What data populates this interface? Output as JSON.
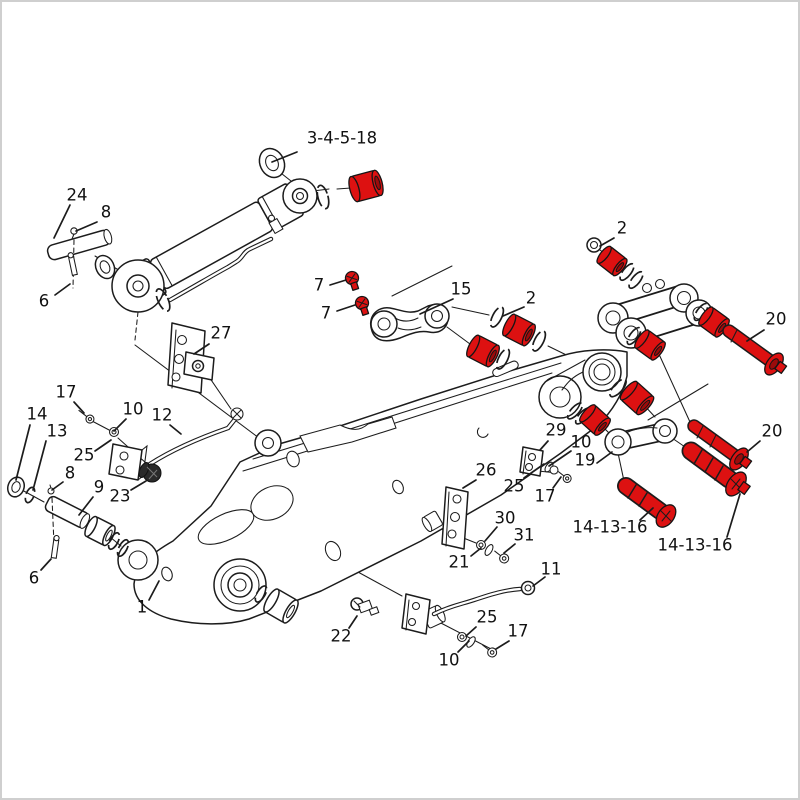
{
  "figure": {
    "kind": "exploded-parts-diagram",
    "subject": "excavator boom, cylinder and linkage parts drawing",
    "highlight_note": "serviced parts (bushings, pins, bolts, fittings) highlighted in red"
  },
  "colors": {
    "line": "#1c1c1c",
    "highlight": "#dd1111",
    "highlight_dark": "#9c0b0b",
    "background": "#ffffff",
    "frame_border": "#cfcfcf",
    "label": "#111111"
  },
  "callouts": [
    {
      "text": "3-4-5-18",
      "x": 342,
      "y": 139,
      "lx1": 297,
      "ly1": 152,
      "lx2": 272,
      "ly2": 162
    },
    {
      "text": "24",
      "x": 77,
      "y": 196,
      "lx1": 70,
      "ly1": 205,
      "lx2": 54,
      "ly2": 238
    },
    {
      "text": "8",
      "x": 106,
      "y": 213,
      "lx1": 97,
      "ly1": 222,
      "lx2": 76,
      "ly2": 231
    },
    {
      "text": "6",
      "x": 44,
      "y": 302,
      "lx1": 55,
      "ly1": 295,
      "lx2": 70,
      "ly2": 284
    },
    {
      "text": "7",
      "x": 319,
      "y": 286,
      "lx1": 330,
      "ly1": 285,
      "lx2": 346,
      "ly2": 280
    },
    {
      "text": "7",
      "x": 326,
      "y": 314,
      "lx1": 337,
      "ly1": 311,
      "lx2": 355,
      "ly2": 305
    },
    {
      "text": "15",
      "x": 461,
      "y": 290,
      "lx1": 453,
      "ly1": 299,
      "lx2": 420,
      "ly2": 314
    },
    {
      "text": "2",
      "x": 531,
      "y": 299,
      "lx1": 524,
      "ly1": 307,
      "lx2": 503,
      "ly2": 316
    },
    {
      "text": "2",
      "x": 622,
      "y": 229,
      "lx1": 614,
      "ly1": 238,
      "lx2": 600,
      "ly2": 246
    },
    {
      "text": "20",
      "x": 776,
      "y": 320,
      "lx1": 764,
      "ly1": 330,
      "lx2": 747,
      "ly2": 341
    },
    {
      "text": "20",
      "x": 772,
      "y": 432,
      "lx1": 760,
      "ly1": 441,
      "lx2": 747,
      "ly2": 452
    },
    {
      "text": "14-13-16",
      "x": 610,
      "y": 528,
      "lx1": 640,
      "ly1": 520,
      "lx2": 653,
      "ly2": 508
    },
    {
      "text": "14-13-16",
      "x": 695,
      "y": 546,
      "lx1": 727,
      "ly1": 537,
      "lx2": 740,
      "ly2": 494
    },
    {
      "text": "27",
      "x": 221,
      "y": 334,
      "lx1": 209,
      "ly1": 344,
      "lx2": 194,
      "ly2": 354
    },
    {
      "text": "17",
      "x": 66,
      "y": 393,
      "lx1": 74,
      "ly1": 402,
      "lx2": 84,
      "ly2": 413
    },
    {
      "text": "14",
      "x": 37,
      "y": 415,
      "lx1": 30,
      "ly1": 425,
      "lx2": 16,
      "ly2": 480
    },
    {
      "text": "13",
      "x": 57,
      "y": 432,
      "lx1": 46,
      "ly1": 441,
      "lx2": 33,
      "ly2": 490
    },
    {
      "text": "10",
      "x": 133,
      "y": 410,
      "lx1": 126,
      "ly1": 419,
      "lx2": 114,
      "ly2": 431
    },
    {
      "text": "12",
      "x": 162,
      "y": 416,
      "lx1": 170,
      "ly1": 425,
      "lx2": 181,
      "ly2": 434
    },
    {
      "text": "25",
      "x": 84,
      "y": 456,
      "lx1": 95,
      "ly1": 451,
      "lx2": 111,
      "ly2": 440
    },
    {
      "text": "8",
      "x": 70,
      "y": 474,
      "lx1": 63,
      "ly1": 482,
      "lx2": 52,
      "ly2": 490
    },
    {
      "text": "9",
      "x": 99,
      "y": 488,
      "lx1": 93,
      "ly1": 497,
      "lx2": 79,
      "ly2": 515
    },
    {
      "text": "23",
      "x": 120,
      "y": 497,
      "lx1": 131,
      "ly1": 490,
      "lx2": 146,
      "ly2": 481
    },
    {
      "text": "6",
      "x": 34,
      "y": 579,
      "lx1": 41,
      "ly1": 570,
      "lx2": 51,
      "ly2": 559
    },
    {
      "text": "1",
      "x": 142,
      "y": 608,
      "lx1": 149,
      "ly1": 600,
      "lx2": 159,
      "ly2": 581
    },
    {
      "text": "26",
      "x": 486,
      "y": 471,
      "lx1": 476,
      "ly1": 480,
      "lx2": 463,
      "ly2": 488
    },
    {
      "text": "29",
      "x": 556,
      "y": 431,
      "lx1": 548,
      "ly1": 441,
      "lx2": 540,
      "ly2": 450
    },
    {
      "text": "10",
      "x": 581,
      "y": 443,
      "lx1": 571,
      "ly1": 451,
      "lx2": 549,
      "ly2": 466
    },
    {
      "text": "19",
      "x": 585,
      "y": 461,
      "lx1": 597,
      "ly1": 463,
      "lx2": 612,
      "ly2": 452
    },
    {
      "text": "25",
      "x": 514,
      "y": 487,
      "lx1": 524,
      "ly1": 478,
      "lx2": 544,
      "ly2": 464
    },
    {
      "text": "17",
      "x": 545,
      "y": 497,
      "lx1": 553,
      "ly1": 488,
      "lx2": 561,
      "ly2": 477
    },
    {
      "text": "30",
      "x": 505,
      "y": 519,
      "lx1": 497,
      "ly1": 527,
      "lx2": 485,
      "ly2": 541
    },
    {
      "text": "31",
      "x": 524,
      "y": 536,
      "lx1": 515,
      "ly1": 544,
      "lx2": 504,
      "ly2": 553
    },
    {
      "text": "21",
      "x": 459,
      "y": 563,
      "lx1": 471,
      "ly1": 556,
      "lx2": 481,
      "ly2": 548
    },
    {
      "text": "11",
      "x": 551,
      "y": 570,
      "lx1": 545,
      "ly1": 577,
      "lx2": 533,
      "ly2": 586
    },
    {
      "text": "22",
      "x": 341,
      "y": 637,
      "lx1": 349,
      "ly1": 628,
      "lx2": 357,
      "ly2": 616
    },
    {
      "text": "25",
      "x": 487,
      "y": 618,
      "lx1": 476,
      "ly1": 627,
      "lx2": 466,
      "ly2": 636
    },
    {
      "text": "10",
      "x": 449,
      "y": 661,
      "lx1": 458,
      "ly1": 652,
      "lx2": 469,
      "ly2": 641
    },
    {
      "text": "17",
      "x": 518,
      "y": 632,
      "lx1": 509,
      "ly1": 641,
      "lx2": 496,
      "ly2": 649
    }
  ]
}
